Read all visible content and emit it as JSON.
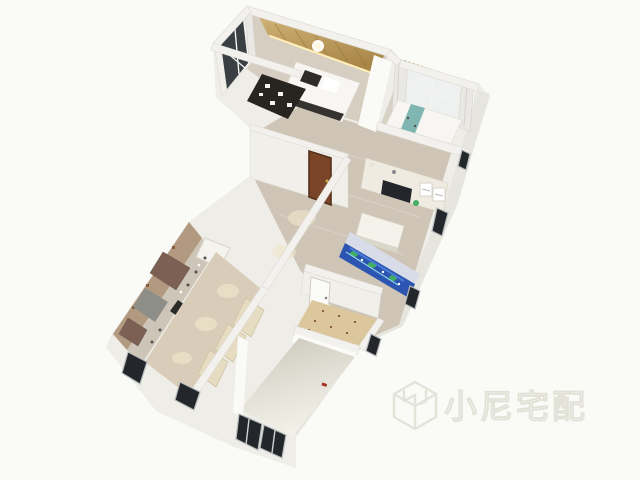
{
  "scene": {
    "description": "3D isometric rendering of an apartment floor plan viewed from above",
    "rooms": [
      "master-bedroom",
      "bedroom-2",
      "study-living-room",
      "entry-hall",
      "kitchen",
      "wardrobe-corridor",
      "bathroom",
      "empty-room"
    ]
  },
  "watermark": {
    "text": "小尼宅配",
    "logo": "cube-n-logo"
  },
  "palette": {
    "background": "#fafaf6",
    "facade": "#eeede7",
    "wall_top": "#f2f1ed",
    "wood_floor": "#cfc5b6",
    "corridor_floor": "#d9cdb9",
    "kitchen_tile": "#b19a7f",
    "bath_tile": "#dcc79c",
    "gold_drapes": "#c0a062",
    "led_glow": "#ffedb8",
    "sofa_blue": "#2b55b0",
    "plant_green": "#3fae62",
    "door_brown": "#7a4428",
    "window_dark": "#23272b",
    "teal_bed_runner": "#7fb6b2",
    "bed_white": "#f7f6f2",
    "wardrobe_beige": "#e6dcc2",
    "cabinet_brown": "#7c6053"
  }
}
